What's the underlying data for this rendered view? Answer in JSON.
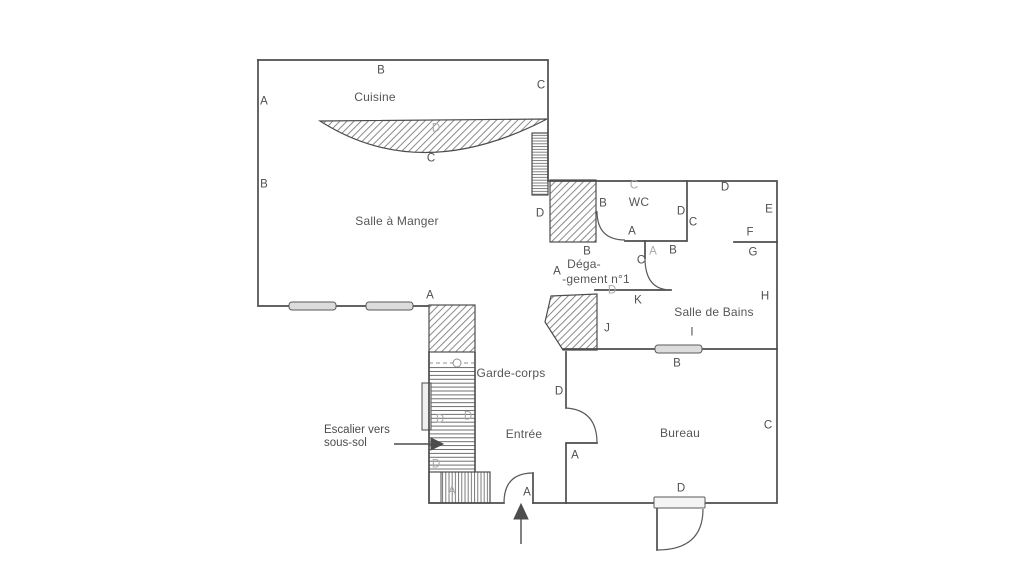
{
  "plan": {
    "colors": {
      "background": "#ffffff",
      "ink": "#4d4d4d",
      "label": "#565656",
      "faded_label": "#a8a8a8",
      "hatch": "#7d7d7d",
      "radiator_fill": "#dcdcdc"
    },
    "rooms": [
      {
        "t": "Cuisine",
        "x": 375,
        "y": 97
      },
      {
        "t": "Salle à Manger",
        "x": 397,
        "y": 221
      },
      {
        "t": "WC",
        "x": 639,
        "y": 202
      },
      {
        "t": "Déga-",
        "x": 584,
        "y": 264
      },
      {
        "t": "-gement n°1",
        "x": 596,
        "y": 279
      },
      {
        "t": "Salle de Bains",
        "x": 714,
        "y": 312
      },
      {
        "t": "Garde-corps",
        "x": 511,
        "y": 373
      },
      {
        "t": "Entrée",
        "x": 524,
        "y": 434
      },
      {
        "t": "Bureau",
        "x": 680,
        "y": 433
      }
    ],
    "note": {
      "line1": "Escalier vers",
      "line2": "sous-sol"
    },
    "letters": [
      {
        "t": "B",
        "x": 381,
        "y": 71
      },
      {
        "t": "A",
        "x": 264,
        "y": 102
      },
      {
        "t": "C",
        "x": 541,
        "y": 86
      },
      {
        "t": "D",
        "x": 436,
        "y": 129,
        "light": true
      },
      {
        "t": "C",
        "x": 431,
        "y": 159
      },
      {
        "t": "B",
        "x": 264,
        "y": 185
      },
      {
        "t": "D",
        "x": 540,
        "y": 214
      },
      {
        "t": "A",
        "x": 430,
        "y": 296
      },
      {
        "t": "C",
        "x": 634,
        "y": 186,
        "light": true
      },
      {
        "t": "B",
        "x": 603,
        "y": 204
      },
      {
        "t": "D",
        "x": 681,
        "y": 212
      },
      {
        "t": "C",
        "x": 693,
        "y": 223
      },
      {
        "t": "A",
        "x": 632,
        "y": 232
      },
      {
        "t": "D",
        "x": 725,
        "y": 188
      },
      {
        "t": "E",
        "x": 769,
        "y": 210
      },
      {
        "t": "F",
        "x": 750,
        "y": 233
      },
      {
        "t": "G",
        "x": 753,
        "y": 253
      },
      {
        "t": "H",
        "x": 765,
        "y": 297
      },
      {
        "t": "B",
        "x": 587,
        "y": 252
      },
      {
        "t": "A",
        "x": 557,
        "y": 272
      },
      {
        "t": "A",
        "x": 653,
        "y": 252,
        "light": true
      },
      {
        "t": "B",
        "x": 673,
        "y": 251
      },
      {
        "t": "C",
        "x": 641,
        "y": 261
      },
      {
        "t": "D",
        "x": 612,
        "y": 291,
        "light": true
      },
      {
        "t": "K",
        "x": 638,
        "y": 301
      },
      {
        "t": "J",
        "x": 607,
        "y": 329
      },
      {
        "t": "I",
        "x": 692,
        "y": 333
      },
      {
        "t": "B",
        "x": 677,
        "y": 364
      },
      {
        "t": "D",
        "x": 440,
        "y": 420,
        "light": true
      },
      {
        "t": "D",
        "x": 468,
        "y": 417,
        "light": true
      },
      {
        "t": "D",
        "x": 436,
        "y": 465,
        "light": true
      },
      {
        "t": "A",
        "x": 452,
        "y": 492,
        "light": true
      },
      {
        "t": "A",
        "x": 527,
        "y": 493
      },
      {
        "t": "D",
        "x": 559,
        "y": 392
      },
      {
        "t": "A",
        "x": 575,
        "y": 456
      },
      {
        "t": "C",
        "x": 768,
        "y": 426
      },
      {
        "t": "D",
        "x": 681,
        "y": 489
      }
    ]
  }
}
